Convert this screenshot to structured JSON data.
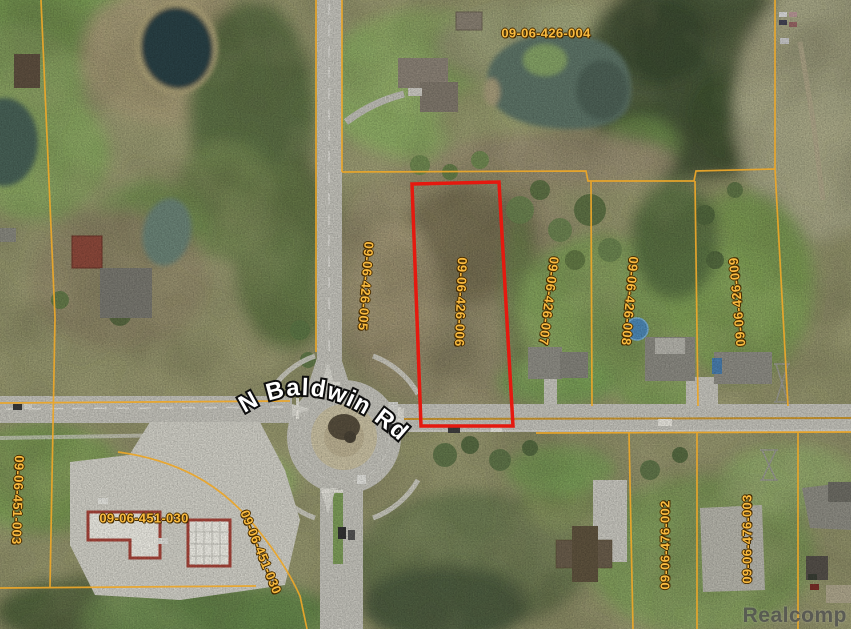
{
  "map": {
    "road_name": "N Baldwin Rd",
    "watermark": "Realcomp",
    "highlighted_parcel_id": "09-06-426-006",
    "colors": {
      "parcel_line": "#eaa62a",
      "parcel_label": "#f9bb40",
      "highlight_outline": "#e5190f",
      "road_label_fill": "#ffffff"
    },
    "parcel_labels": [
      {
        "id": "09-06-426-004"
      },
      {
        "id": "09-06-426-005"
      },
      {
        "id": "09-06-426-006"
      },
      {
        "id": "09-06-426-007"
      },
      {
        "id": "09-06-426-008"
      },
      {
        "id": "09-06-426-009"
      },
      {
        "id": "09-06-451-003"
      },
      {
        "id": "09-06-451-030"
      },
      {
        "id": "09-06-451-030"
      },
      {
        "id": "09-06-476-002"
      },
      {
        "id": "09-06-476-003"
      }
    ]
  }
}
